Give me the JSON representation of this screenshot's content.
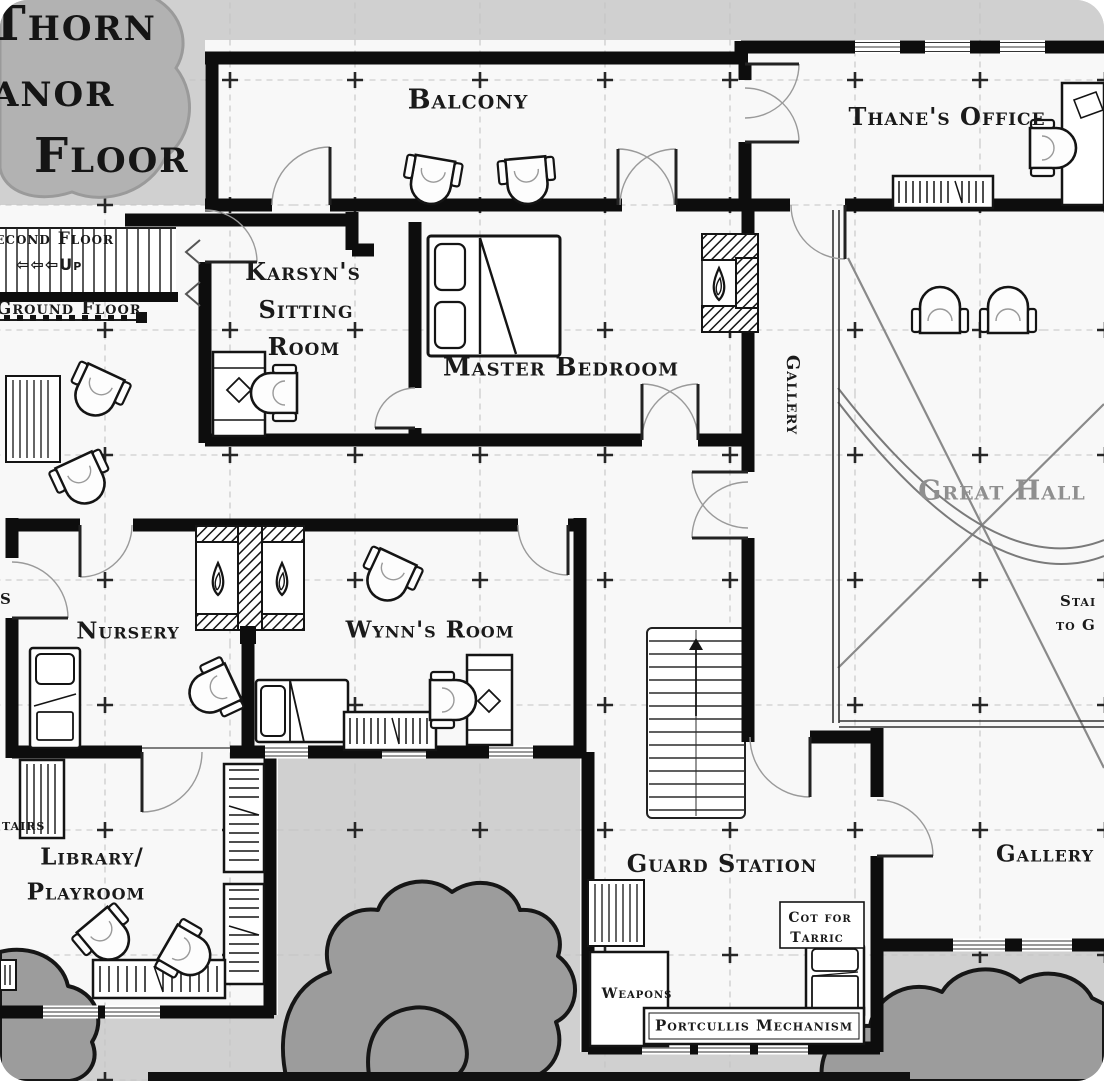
{
  "map_title": {
    "line1": "Thorn",
    "line2": "anor",
    "line3": "Floor"
  },
  "rooms": {
    "balcony": "Balcony",
    "thanes_office": "Thane's Office",
    "karsyns_sitting_room": [
      "Karsyn's",
      "Sitting",
      "Room"
    ],
    "master_bedroom": "Master Bedroom",
    "gallery_west": "Gallery",
    "great_hall": "Great Hall",
    "nursery": "Nursery",
    "wynns_room": "Wynn's Room",
    "library_playroom": [
      "Library/",
      "Playroom"
    ],
    "guard_station": "Guard Station",
    "gallery_southeast": "Gallery"
  },
  "stair_annotations": {
    "second_floor": "Second Floor",
    "up": "⇦⇦⇦Up",
    "ground_floor": "Ground Floor"
  },
  "annotations": {
    "cot_line1": "Cot for",
    "cot_line2": "Tarric",
    "weapons": "Weapons",
    "portcullis_mechanism": "Portcullis Mechanism"
  },
  "edge_fragments": {
    "stairs_left": "tairs",
    "stairs_right_line1": "Stai",
    "stairs_right_line2": "to G",
    "left_s": "S"
  },
  "colors": {
    "wall": "#0d0d0d",
    "room_fill": "#f8f8f8",
    "outside": "#d0d0d0",
    "trees": "#9c9c9c",
    "grid": "#c5c5c5",
    "great_hall_text": "#8f8f8f",
    "label_text": "#1a1a1a"
  }
}
